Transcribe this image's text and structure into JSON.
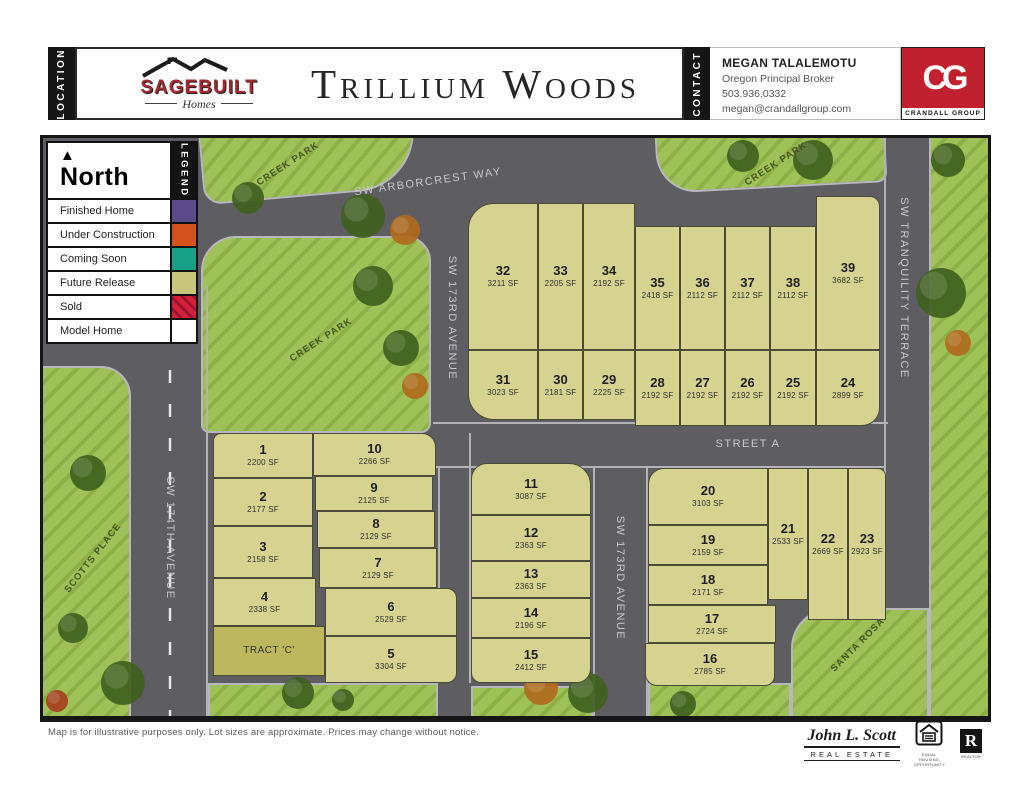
{
  "header": {
    "location_tab": "LOCATION",
    "contact_tab": "CONTACT",
    "title": "Trillium Woods",
    "builder": {
      "name": "SAGEBUILT",
      "tagline": "Homes"
    },
    "contact": {
      "name": "MEGAN TALALEMOTU",
      "title": "Oregon Principal Broker",
      "phone": "503.936.0332",
      "email": "megan@crandallgroup.com"
    },
    "brokerage": {
      "initials": "CG",
      "name": "CRANDALL GROUP",
      "color": "#c1202f"
    }
  },
  "legend": {
    "tab": "LEGEND",
    "north_label": "North",
    "items": [
      {
        "label": "Finished Home",
        "color": "#5a4a8a",
        "style": "solid"
      },
      {
        "label": "Under Construction",
        "color": "#d4521c",
        "style": "solid"
      },
      {
        "label": "Coming Soon",
        "color": "#16a085",
        "style": "solid"
      },
      {
        "label": "Future Release",
        "color": "#c9c67c",
        "style": "solid"
      },
      {
        "label": "Sold",
        "color": "#d42038",
        "stripe_color": "#9e1430",
        "style": "hatch"
      },
      {
        "label": "Model Home",
        "color": "#ffffff",
        "style": "solid"
      }
    ]
  },
  "map": {
    "lots": [
      {
        "n": "1",
        "sf": "2200 SF",
        "x": 170,
        "y": 295,
        "w": 100,
        "h": 45,
        "r": "8px 0 0 0"
      },
      {
        "n": "2",
        "sf": "2177 SF",
        "x": 170,
        "y": 340,
        "w": 100,
        "h": 48
      },
      {
        "n": "3",
        "sf": "2158 SF",
        "x": 170,
        "y": 388,
        "w": 100,
        "h": 52
      },
      {
        "n": "4",
        "sf": "2338 SF",
        "x": 170,
        "y": 440,
        "w": 103,
        "h": 48
      },
      {
        "n": "5",
        "sf": "3304 SF",
        "x": 282,
        "y": 498,
        "w": 132,
        "h": 47,
        "r": "0 0 10px 0"
      },
      {
        "n": "6",
        "sf": "2529 SF",
        "x": 282,
        "y": 450,
        "w": 132,
        "h": 48,
        "r": "0 10px 0 0"
      },
      {
        "n": "7",
        "sf": "2129 SF",
        "x": 276,
        "y": 410,
        "w": 118,
        "h": 40
      },
      {
        "n": "8",
        "sf": "2129 SF",
        "x": 274,
        "y": 373,
        "w": 118,
        "h": 37
      },
      {
        "n": "9",
        "sf": "2125 SF",
        "x": 272,
        "y": 338,
        "w": 118,
        "h": 35
      },
      {
        "n": "10",
        "sf": "2266 SF",
        "x": 270,
        "y": 295,
        "w": 123,
        "h": 43,
        "r": "0 14px 0 0"
      },
      {
        "n": "11",
        "sf": "3087 SF",
        "x": 428,
        "y": 325,
        "w": 120,
        "h": 52,
        "r": "16px 22px 0 0"
      },
      {
        "n": "12",
        "sf": "2363 SF",
        "x": 428,
        "y": 377,
        "w": 120,
        "h": 46
      },
      {
        "n": "13",
        "sf": "2363 SF",
        "x": 428,
        "y": 423,
        "w": 120,
        "h": 37
      },
      {
        "n": "14",
        "sf": "2196 SF",
        "x": 428,
        "y": 460,
        "w": 120,
        "h": 40
      },
      {
        "n": "15",
        "sf": "2412 SF",
        "x": 428,
        "y": 500,
        "w": 120,
        "h": 45,
        "r": "0 0 14px 10px"
      },
      {
        "n": "16",
        "sf": "2785 SF",
        "x": 602,
        "y": 505,
        "w": 130,
        "h": 43,
        "r": "0 0 10px 12px"
      },
      {
        "n": "17",
        "sf": "2724 SF",
        "x": 605,
        "y": 467,
        "w": 128,
        "h": 38
      },
      {
        "n": "18",
        "sf": "2171 SF",
        "x": 605,
        "y": 427,
        "w": 120,
        "h": 40
      },
      {
        "n": "19",
        "sf": "2159 SF",
        "x": 605,
        "y": 387,
        "w": 120,
        "h": 40
      },
      {
        "n": "20",
        "sf": "3103 SF",
        "x": 605,
        "y": 330,
        "w": 120,
        "h": 57,
        "r": "16px 0 0 0"
      },
      {
        "n": "21",
        "sf": "2533 SF",
        "x": 725,
        "y": 330,
        "w": 40,
        "h": 132
      },
      {
        "n": "22",
        "sf": "2669 SF",
        "x": 765,
        "y": 330,
        "w": 40,
        "h": 152
      },
      {
        "n": "23",
        "sf": "2923 SF",
        "x": 805,
        "y": 330,
        "w": 38,
        "h": 152,
        "r": "0 8px 0 0"
      },
      {
        "n": "24",
        "sf": "2899 SF",
        "x": 773,
        "y": 212,
        "w": 64,
        "h": 76,
        "r": "0 0 18px 0"
      },
      {
        "n": "25",
        "sf": "2192 SF",
        "x": 727,
        "y": 212,
        "w": 46,
        "h": 76
      },
      {
        "n": "26",
        "sf": "2192 SF",
        "x": 682,
        "y": 212,
        "w": 45,
        "h": 76
      },
      {
        "n": "27",
        "sf": "2192 SF",
        "x": 637,
        "y": 212,
        "w": 45,
        "h": 76
      },
      {
        "n": "28",
        "sf": "2192 SF",
        "x": 592,
        "y": 212,
        "w": 45,
        "h": 76
      },
      {
        "n": "29",
        "sf": "2225 SF",
        "x": 540,
        "y": 212,
        "w": 52,
        "h": 70
      },
      {
        "n": "30",
        "sf": "2181 SF",
        "x": 495,
        "y": 212,
        "w": 45,
        "h": 70
      },
      {
        "n": "31",
        "sf": "3023 SF",
        "x": 425,
        "y": 212,
        "w": 70,
        "h": 70,
        "r": "0 0 0 26px"
      },
      {
        "n": "32",
        "sf": "3211 SF",
        "x": 425,
        "y": 65,
        "w": 70,
        "h": 147,
        "r": "26px 0 0 0"
      },
      {
        "n": "33",
        "sf": "2205 SF",
        "x": 495,
        "y": 65,
        "w": 45,
        "h": 147
      },
      {
        "n": "34",
        "sf": "2192 SF",
        "x": 540,
        "y": 65,
        "w": 52,
        "h": 147
      },
      {
        "n": "35",
        "sf": "2418 SF",
        "x": 592,
        "y": 88,
        "w": 45,
        "h": 124
      },
      {
        "n": "36",
        "sf": "2112 SF",
        "x": 637,
        "y": 88,
        "w": 45,
        "h": 124
      },
      {
        "n": "37",
        "sf": "2112 SF",
        "x": 682,
        "y": 88,
        "w": 45,
        "h": 124
      },
      {
        "n": "38",
        "sf": "2112 SF",
        "x": 727,
        "y": 88,
        "w": 46,
        "h": 124
      },
      {
        "n": "39",
        "sf": "3682 SF",
        "x": 773,
        "y": 58,
        "w": 64,
        "h": 154,
        "r": "0 10px 0 0"
      }
    ],
    "tract": {
      "label": "TRACT 'C'",
      "x": 170,
      "y": 488,
      "w": 112,
      "h": 50
    },
    "street_labels": [
      {
        "text": "SW ARBORCREST WAY",
        "x": 385,
        "y": 44,
        "rot": -8,
        "kind": "road"
      },
      {
        "text": "SW 173RD AVENUE",
        "x": 409,
        "y": 180,
        "rot": 90,
        "kind": "road"
      },
      {
        "text": "SW 173RD AVENUE",
        "x": 577,
        "y": 440,
        "rot": 90,
        "kind": "road"
      },
      {
        "text": "SW TRANQUILITY TERRACE",
        "x": 861,
        "y": 150,
        "rot": 90,
        "kind": "road"
      },
      {
        "text": "SW 174TH AVENUE",
        "x": 127,
        "y": 400,
        "rot": 90,
        "kind": "road"
      },
      {
        "text": "STREET A",
        "x": 705,
        "y": 306,
        "rot": 0,
        "kind": "road"
      },
      {
        "text": "CREEK PARK",
        "x": 245,
        "y": 26,
        "rot": -33,
        "kind": "park"
      },
      {
        "text": "CREEK PARK",
        "x": 278,
        "y": 202,
        "rot": -33,
        "kind": "park"
      },
      {
        "text": "CREEK PARK",
        "x": 733,
        "y": 26,
        "rot": -33,
        "kind": "park"
      },
      {
        "text": "SCOTTS PLACE",
        "x": 50,
        "y": 420,
        "rot": -52,
        "kind": "park"
      },
      {
        "text": "SANTA ROSA",
        "x": 815,
        "y": 507,
        "rot": -45,
        "kind": "park"
      }
    ]
  },
  "footer": {
    "disclaimer": "Map is for illustrative purposes only.  Lot sizes are approximate.  Prices may change without notice.",
    "jls_name": "John L. Scott",
    "jls_sub": "REAL ESTATE",
    "equal_housing_caption": "EQUAL HOUSING OPPORTUNITY",
    "realtor_caption": "REALTOR",
    "realtor_r": "R"
  }
}
